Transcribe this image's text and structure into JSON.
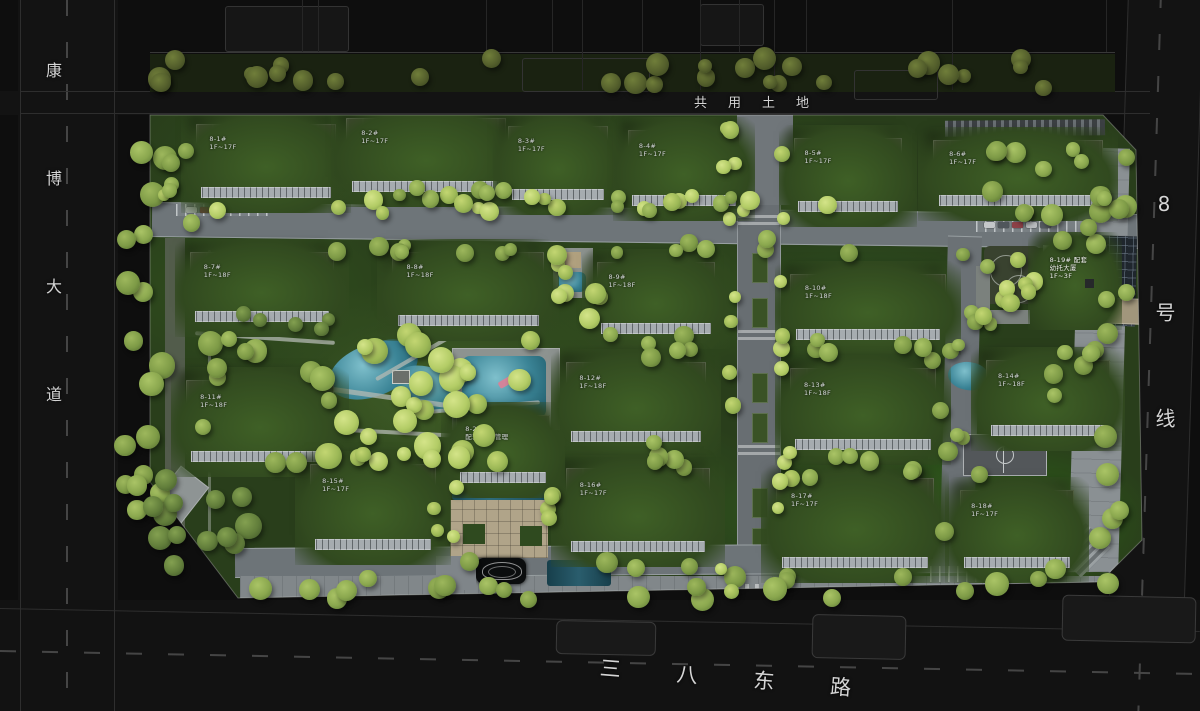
{
  "title": "residential community master plan",
  "roads": {
    "west": "康博大道",
    "north": "共用土地",
    "east": "8号线",
    "south": "三八东路"
  },
  "buildings": [
    {
      "id": "b01",
      "label": "8-1#\n1F~17F"
    },
    {
      "id": "b02",
      "label": "8-2#\n1F~17F"
    },
    {
      "id": "b03",
      "label": "8-3#\n1F~17F"
    },
    {
      "id": "b04",
      "label": "8-4#\n1F~17F"
    },
    {
      "id": "b05",
      "label": "8-5#\n1F~17F"
    },
    {
      "id": "b06",
      "label": "8-6#\n1F~17F"
    },
    {
      "id": "b07",
      "label": "8-7#\n1F~18F"
    },
    {
      "id": "b08",
      "label": "8-8#\n1F~18F"
    },
    {
      "id": "b09",
      "label": "8-9#\n1F~18F"
    },
    {
      "id": "b10",
      "label": "8-10#\n1F~18F"
    },
    {
      "id": "b11",
      "label": "8-11#\n1F~18F"
    },
    {
      "id": "b12",
      "label": "8-12#\n1F~18F"
    },
    {
      "id": "b13",
      "label": "8-13#\n1F~18F"
    },
    {
      "id": "b14",
      "label": "8-14#\n1F~18F"
    },
    {
      "id": "b15",
      "label": "8-15#\n1F~17F"
    },
    {
      "id": "b16",
      "label": "8-16#\n1F~17F"
    },
    {
      "id": "b17",
      "label": "8-17#\n1F~17F"
    },
    {
      "id": "b18",
      "label": "8-18#\n1F~17F"
    },
    {
      "id": "kg",
      "label": "8-19# 配套\n幼托大厦\n1F~3F",
      "type": "light"
    },
    {
      "id": "prop",
      "label": "8-21#\n配套 物业管理"
    }
  ],
  "colors": {
    "water": "#3b8496",
    "lawn": "#2c421d",
    "roof": "#3e3a36",
    "tree": "#a9c161",
    "road_text": "#d5d5d5",
    "plaza_tan": "#b0a489"
  }
}
